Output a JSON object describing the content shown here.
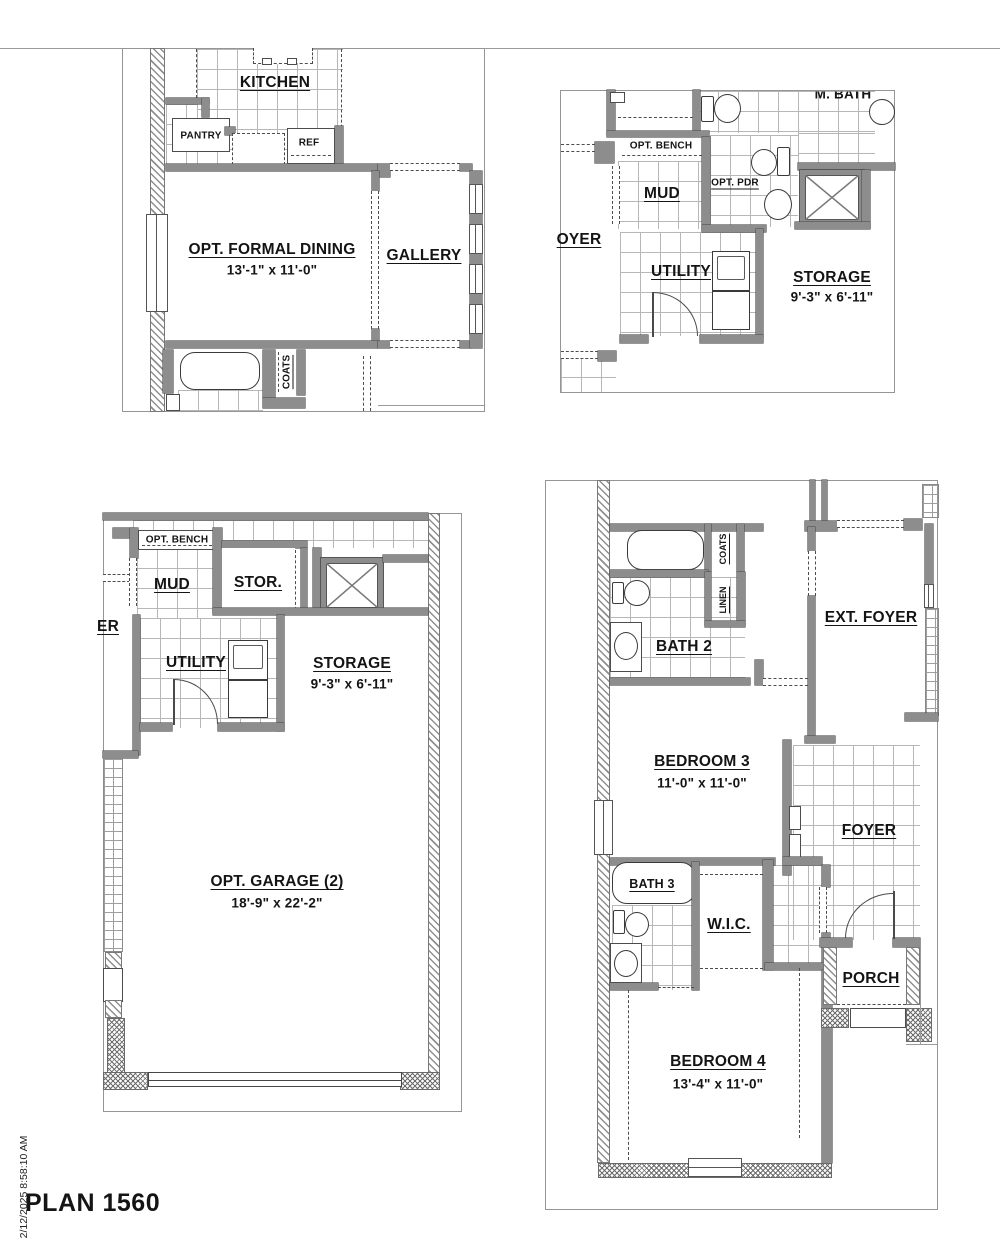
{
  "title": "PLAN 1560",
  "timestamp": "2/12/2025 8:58:10 AM",
  "colors": {
    "wall_fill": "#8d8d8d",
    "line": "#4c4c4c",
    "tile_line": "#b7b7b7",
    "panel_border": "#959595"
  },
  "a": {
    "kitchen": "KITCHEN",
    "pantry": "PANTRY",
    "ref": "REF",
    "dining": "OPT. FORMAL DINING",
    "dining_dims": "13'-1\" x 11'-0\"",
    "gallery": "GALLERY",
    "coats": "COATS"
  },
  "b": {
    "m_bath": "M. BATH",
    "opt_bench": "OPT. BENCH",
    "mud": "MUD",
    "opt_pdr": "OPT. PDR",
    "foyer": "OYER",
    "utility": "UTILITY",
    "storage": "STORAGE",
    "storage_dims": "9'-3\" x 6'-11\""
  },
  "c": {
    "opt_bench": "OPT. BENCH",
    "mud": "MUD",
    "stor": "STOR.",
    "foyer": "ER",
    "utility": "UTILITY",
    "storage": "STORAGE",
    "storage_dims": "9'-3\" x 6'-11\"",
    "garage": "OPT. GARAGE (2)",
    "garage_dims": "18'-9\" x 22'-2\""
  },
  "d": {
    "bath2": "BATH 2",
    "coats": "COATS",
    "linen": "LINEN",
    "ext_foyer": "EXT. FOYER",
    "bedroom3": "BEDROOM 3",
    "bedroom3_dims": "11'-0\" x 11'-0\"",
    "foyer": "FOYER",
    "bath3": "BATH 3",
    "wic": "W.I.C.",
    "porch": "PORCH",
    "bedroom4": "BEDROOM 4",
    "bedroom4_dims": "13'-4\" x 11'-0\""
  }
}
